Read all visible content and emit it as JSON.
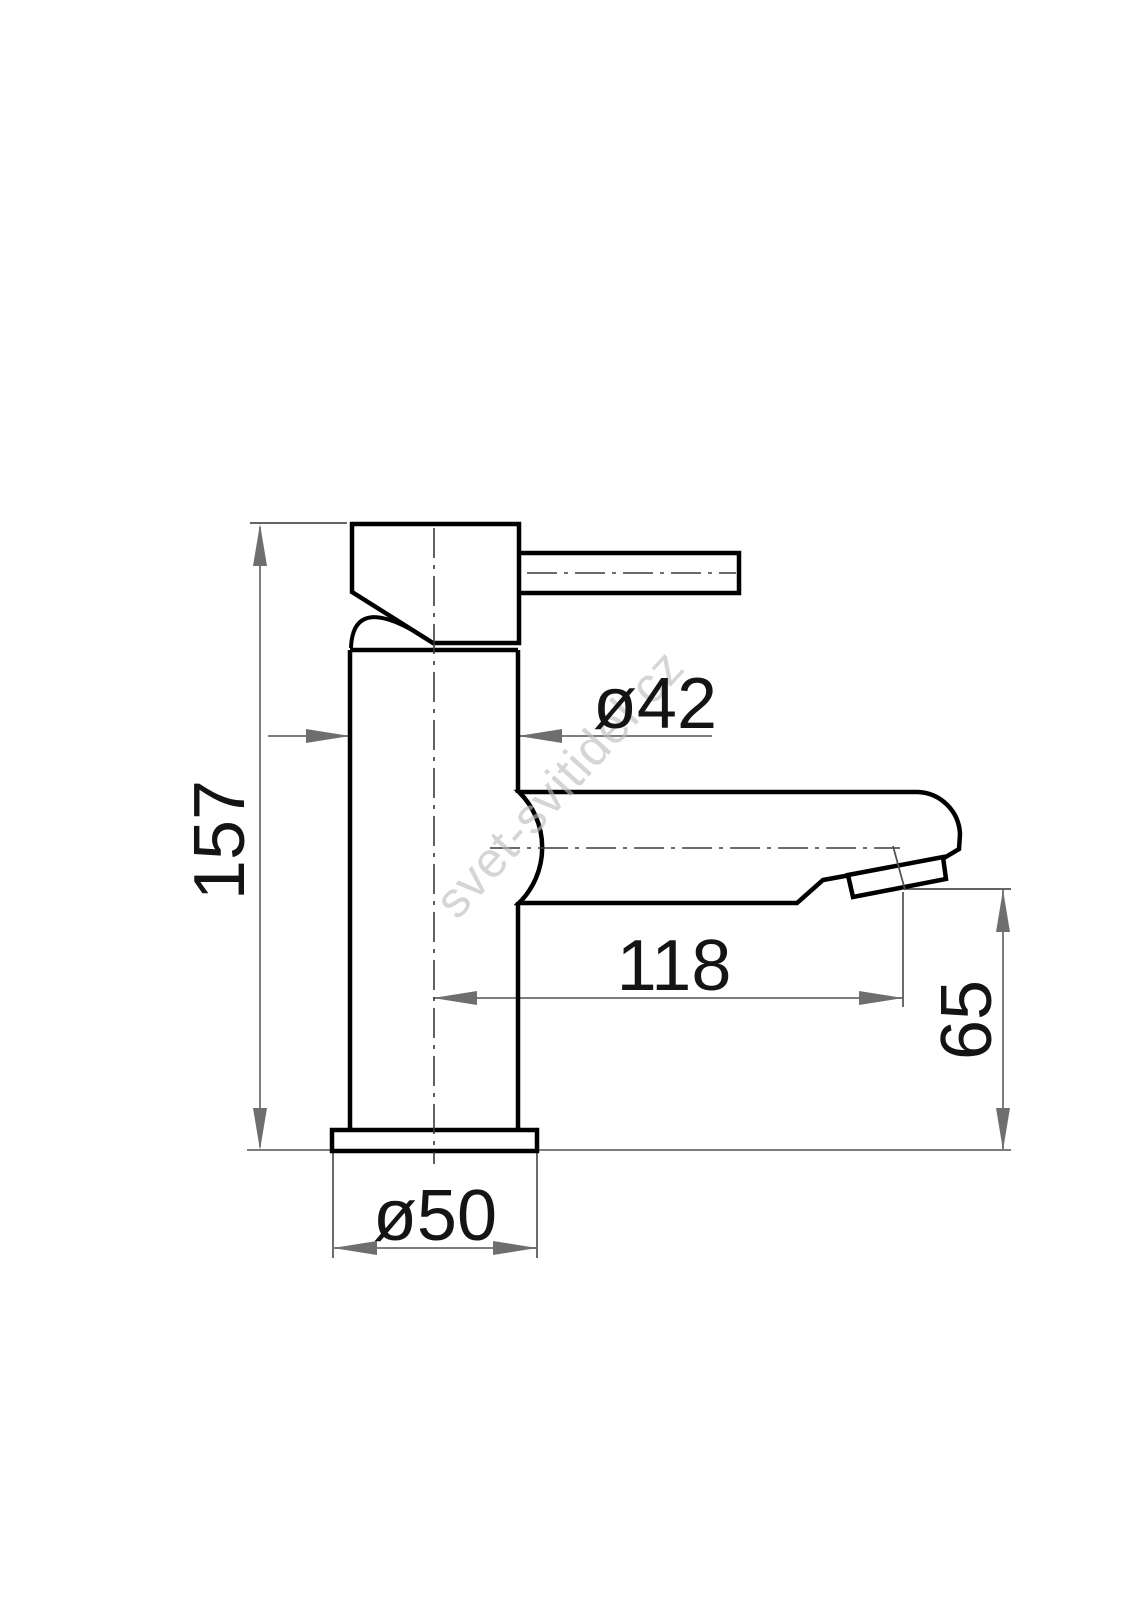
{
  "watermark": {
    "text": "svet-svitidel.cz"
  },
  "dimensions": {
    "total_height": "157",
    "body_diameter": "ø42",
    "spout_reach": "118",
    "spout_height": "65",
    "base_diameter": "ø50"
  },
  "colors": {
    "outline": "#000000",
    "dim": "#7d7d7d",
    "ext": "#4f4f4f",
    "center": "#3a3a3a",
    "arrow": "#6e6e6e",
    "text": "#141414",
    "watermark": "#bcbcbc"
  }
}
